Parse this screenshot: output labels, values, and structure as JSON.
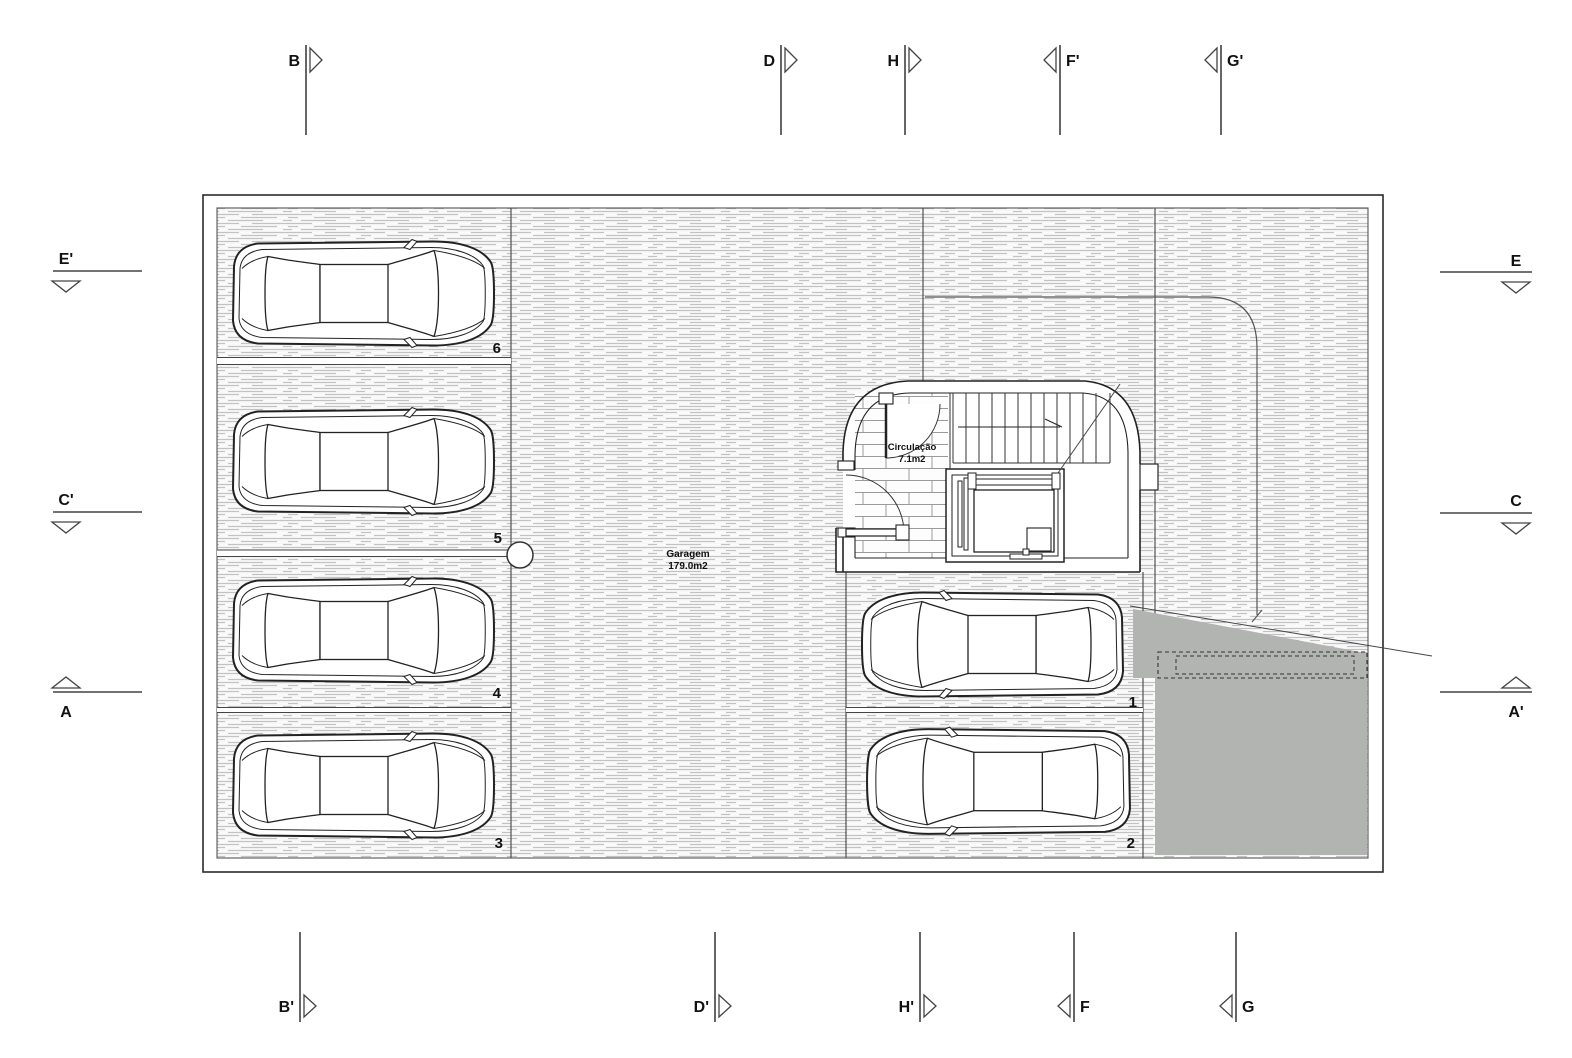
{
  "drawing": {
    "type": "garage-floor-plan",
    "garage": {
      "name": "Garagem",
      "area": "179.0m2"
    },
    "circulation": {
      "name": "Circulação",
      "area": "7.1m2"
    },
    "stalls": [
      {
        "number": "6"
      },
      {
        "number": "5"
      },
      {
        "number": "4"
      },
      {
        "number": "3"
      },
      {
        "number": "1"
      },
      {
        "number": "2"
      }
    ]
  },
  "markers": {
    "top": [
      {
        "label": "B"
      },
      {
        "label": "D"
      },
      {
        "label": "H"
      },
      {
        "label": "F'"
      },
      {
        "label": "G'"
      }
    ],
    "bottom": [
      {
        "label": "B'"
      },
      {
        "label": "D'"
      },
      {
        "label": "H'"
      },
      {
        "label": "F"
      },
      {
        "label": "G"
      }
    ],
    "left": [
      {
        "label": "E'"
      },
      {
        "label": "C'"
      },
      {
        "label": "A"
      }
    ],
    "right": [
      {
        "label": "E"
      },
      {
        "label": "C"
      },
      {
        "label": "A'"
      }
    ]
  },
  "colors": {
    "line": "#222222",
    "hatch_stroke": "#c2c2c2",
    "hatch_bg": "#f3f3f3",
    "ramp_gray": "#b2b4b1",
    "background": "#ffffff"
  }
}
